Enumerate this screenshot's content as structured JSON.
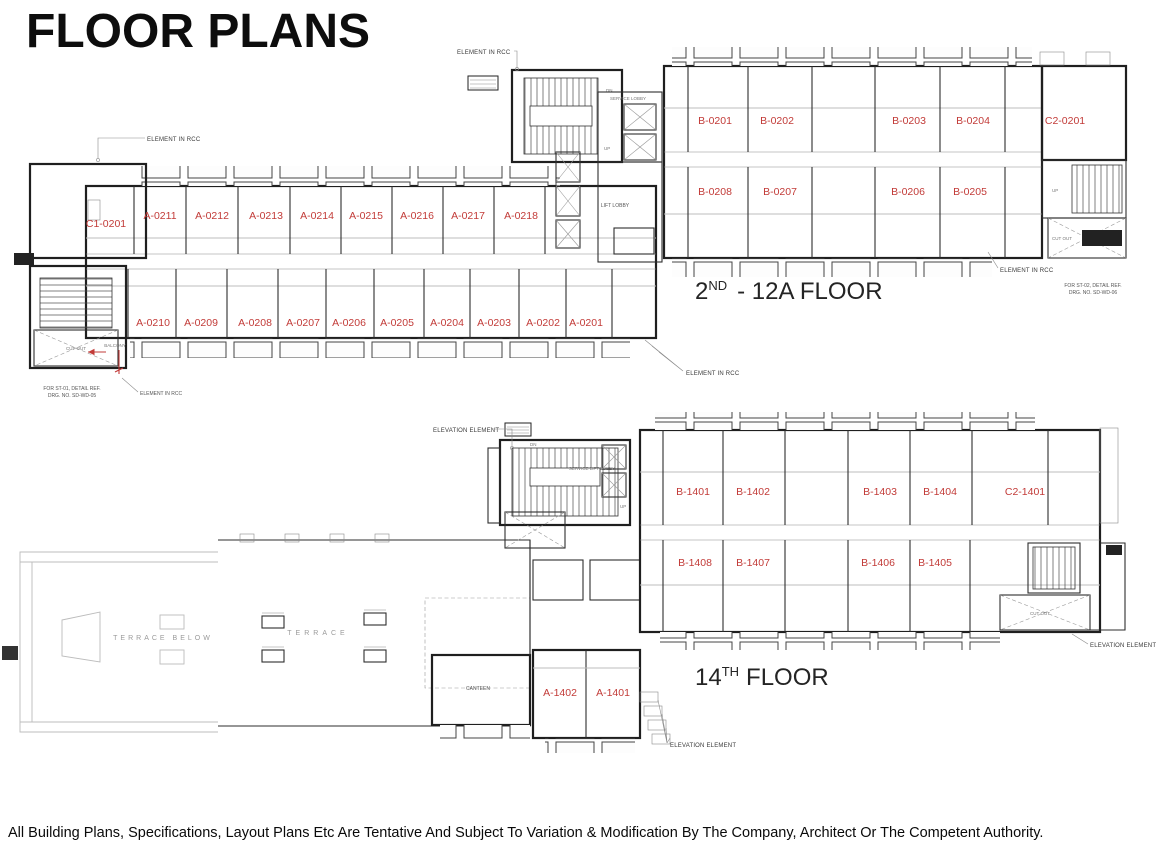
{
  "page": {
    "title": "FLOOR PLANS",
    "disclaimer": "All Building Plans, Specifications, Layout Plans Etc Are Tentative And Subject To Variation & Modification By The Company, Architect Or The Competent Authority."
  },
  "colors": {
    "unit_label": "#c23b38",
    "wall": "#1f1f1f",
    "annotation": "#3a3a3a",
    "terrace_text": "#9a9a9a"
  },
  "upper_plan": {
    "caption": {
      "number": "2",
      "suffix": "ND",
      "rest": "- 12A FLOOR"
    },
    "units_top_left": [
      "C1-0201",
      "A-0211",
      "A-0212",
      "A-0213",
      "A-0214",
      "A-0215",
      "A-0216",
      "A-0217",
      "A-0218"
    ],
    "units_bottom_left": [
      "A-0210",
      "A-0209",
      "A-0208",
      "A-0207",
      "A-0206",
      "A-0205",
      "A-0204",
      "A-0203",
      "A-0202",
      "A-0201"
    ],
    "units_top_right": [
      "B-0201",
      "B-0202",
      "B-0203",
      "B-0204",
      "C2-0201"
    ],
    "units_bottom_right": [
      "B-0208",
      "B-0207",
      "B-0206",
      "B-0205"
    ]
  },
  "lower_plan": {
    "caption": {
      "number": "14",
      "suffix": "TH",
      "rest": "FLOOR"
    },
    "units_top_right": [
      "B-1401",
      "B-1402",
      "B-1403",
      "B-1404",
      "C2-1401"
    ],
    "units_bottom_right": [
      "B-1408",
      "B-1407",
      "B-1406",
      "B-1405"
    ],
    "units_bottom_center": [
      "A-1402",
      "A-1401"
    ],
    "rooms": {
      "canteen": "CANTEEN",
      "terrace": "TERRACE",
      "terrace_below": "TERRACE BELOW"
    }
  },
  "labels": {
    "element_in_rcc": "ELEMENT IN RCC",
    "elevation_element": "ELEVATION ELEMENT",
    "st01_line1": "FOR ST-01, DETAIL REF.",
    "st01_line2": "DRG. NO. SD-WD-05",
    "st02_line1": "FOR ST-02, DETAIL REF.",
    "st02_line2": "DRG. NO. SD-WD-06",
    "lift_lobby": "LIFT LOBBY",
    "service_lobby": "SERVICE LOBBY",
    "service_lift_lobby": "SERVICE LIFT LOBBY",
    "cut_out": "CUT OUT",
    "up": "UP",
    "dn": "DN",
    "balcony": "BALCONY"
  }
}
